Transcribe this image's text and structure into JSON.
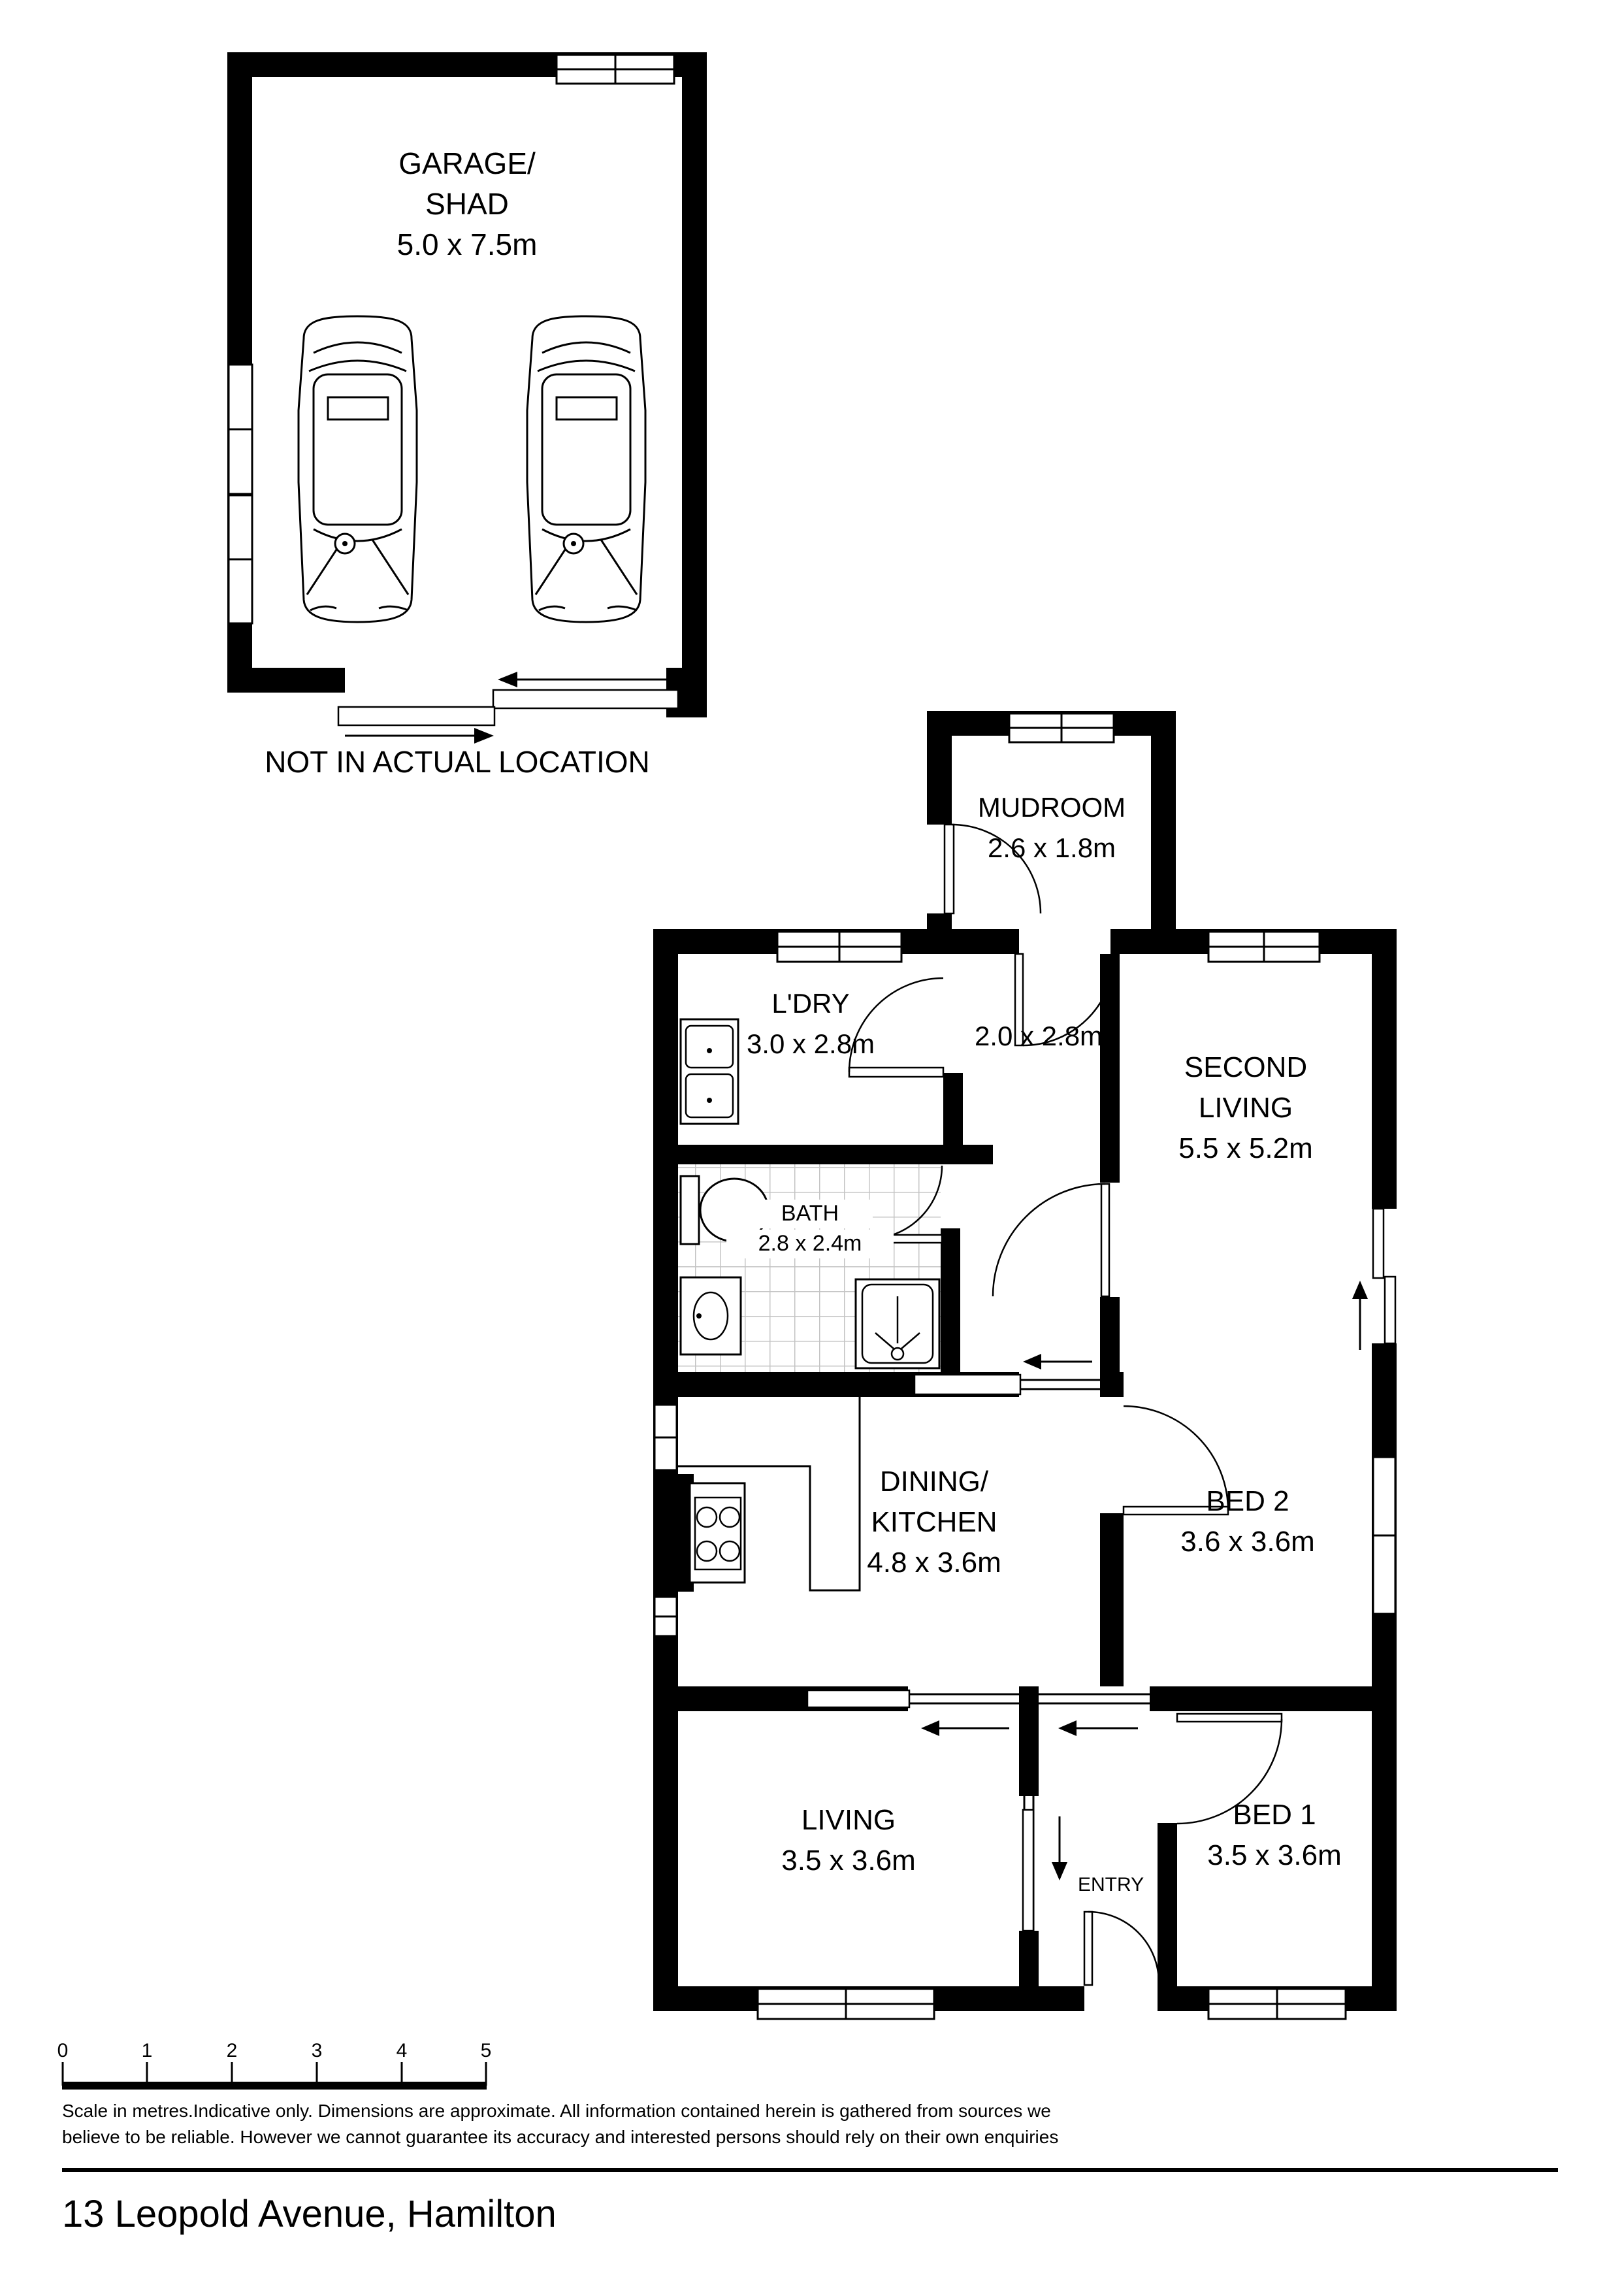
{
  "garage": {
    "label_line1": "GARAGE/",
    "label_line2": "SHAD",
    "dims": "5.0 x 7.5m",
    "note": "NOT IN ACTUAL LOCATION"
  },
  "rooms": {
    "mudroom": {
      "name": "MUDROOM",
      "dims": "2.6 x 1.8m"
    },
    "laundry": {
      "name": "L'DRY",
      "dims": "3.0 x 2.8m"
    },
    "hall": {
      "dims": "2.0 x 2.8m"
    },
    "second_living": {
      "name_line1": "SECOND",
      "name_line2": "LIVING",
      "dims": "5.5 x 5.2m"
    },
    "bath": {
      "name": "BATH",
      "dims": "2.8 x 2.4m"
    },
    "dining_kitchen": {
      "name_line1": "DINING/",
      "name_line2": "KITCHEN",
      "dims": "4.8 x 3.6m"
    },
    "bed2": {
      "name": "BED 2",
      "dims": "3.6 x 3.6m"
    },
    "living": {
      "name": "LIVING",
      "dims": "3.5 x 3.6m"
    },
    "bed1": {
      "name": "BED 1",
      "dims": "3.5 x 3.6m"
    },
    "entry": {
      "name": "ENTRY"
    }
  },
  "scale_bar": {
    "ticks": [
      "0",
      "1",
      "2",
      "3",
      "4",
      "5"
    ]
  },
  "disclaimer_line1": "Scale in metres.Indicative only. Dimensions are approximate. All information contained herein is gathered from sources we",
  "disclaimer_line2": "believe to be reliable. However we cannot guarantee its accuracy and interested persons should rely on their own enquiries",
  "address": "13 Leopold Avenue, Hamilton",
  "colors": {
    "walls": "#000000",
    "tile_line": "#c4c4c4",
    "background": "#ffffff"
  }
}
